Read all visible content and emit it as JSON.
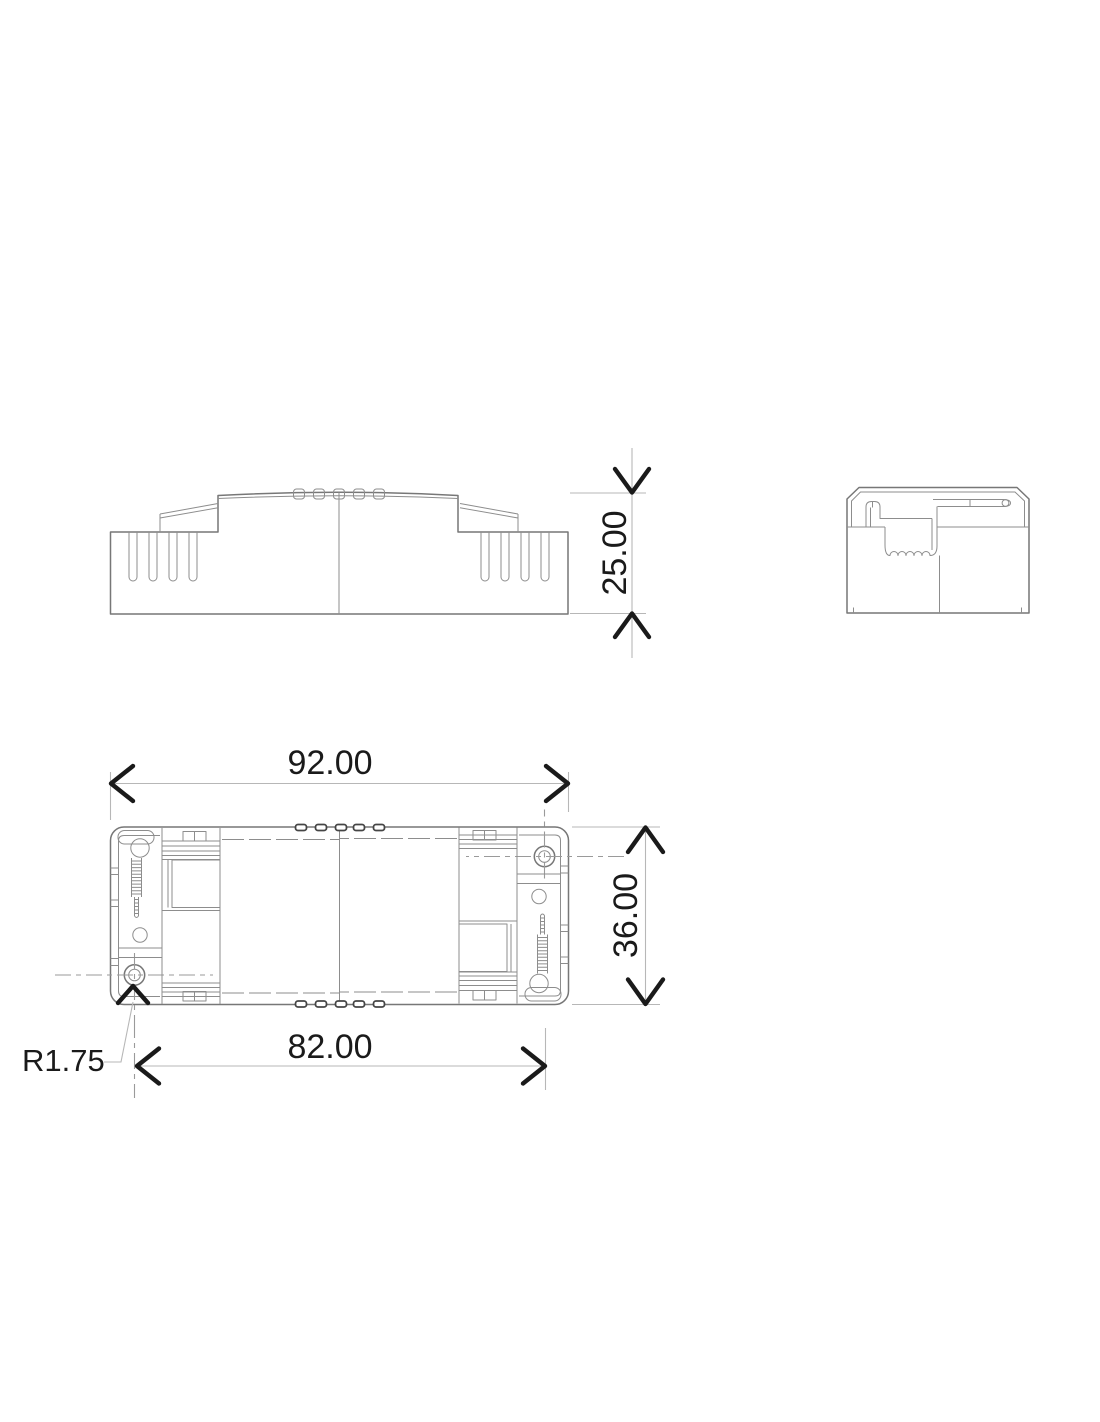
{
  "drawing": {
    "type": "technical-dimension-drawing",
    "background": "#ffffff",
    "colors": {
      "linework": "#777777",
      "dimension_lines": "#b7b7b7",
      "dimension_text": "#1a1a1a",
      "centerlines": "#9a9a9a"
    },
    "views": {
      "side": "side-elevation-view",
      "end": "end-section-view",
      "plan": "plan-view"
    },
    "dimensions": {
      "height": "25.00",
      "overall_width": "92.00",
      "overall_depth": "36.00",
      "mounting_span": "82.00",
      "corner_radius": "R1.75"
    }
  }
}
